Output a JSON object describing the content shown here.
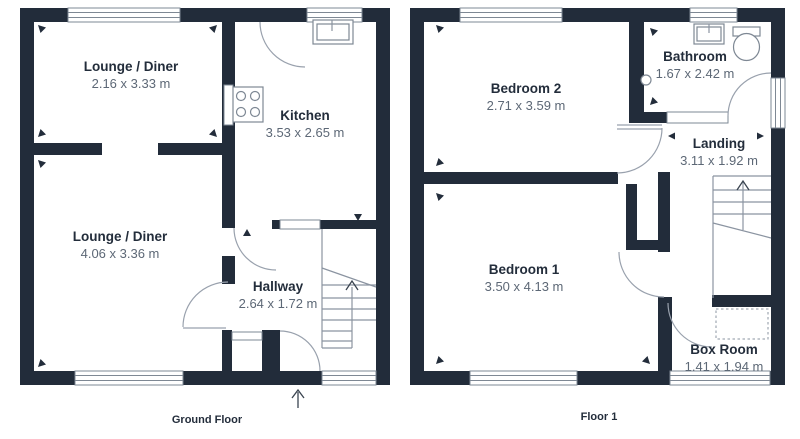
{
  "title": "Two storey house floorplan",
  "colors": {
    "wall": "#222c3a",
    "thin_line": "#8b94a1",
    "room_name_text": "#232d3b",
    "dimension_text": "#5d6876",
    "background": "#ffffff"
  },
  "floors": [
    {
      "label": "Ground Floor",
      "rooms": [
        {
          "name": "Lounge / Diner",
          "dims": "2.16 x 3.33 m"
        },
        {
          "name": "Kitchen",
          "dims": "3.53 x 2.65 m"
        },
        {
          "name": "Lounge / Diner",
          "dims": "4.06 x 3.36 m"
        },
        {
          "name": "Hallway",
          "dims": "2.64 x 1.72 m"
        }
      ],
      "features": [
        "window",
        "back-door",
        "sink",
        "hob",
        "stairs-up",
        "entrance-arrow"
      ]
    },
    {
      "label": "Floor 1",
      "rooms": [
        {
          "name": "Bedroom 2",
          "dims": "2.71 x 3.59 m"
        },
        {
          "name": "Bathroom",
          "dims": "1.67 x 2.42 m"
        },
        {
          "name": "Landing",
          "dims": "3.11 x 1.92 m"
        },
        {
          "name": "Bedroom 1",
          "dims": "3.50 x 4.13 m"
        },
        {
          "name": "Box Room",
          "dims": "1.41 x 1.94 m"
        }
      ],
      "features": [
        "window",
        "sink",
        "toilet",
        "stairs-up",
        "loft-hatch"
      ]
    }
  ]
}
